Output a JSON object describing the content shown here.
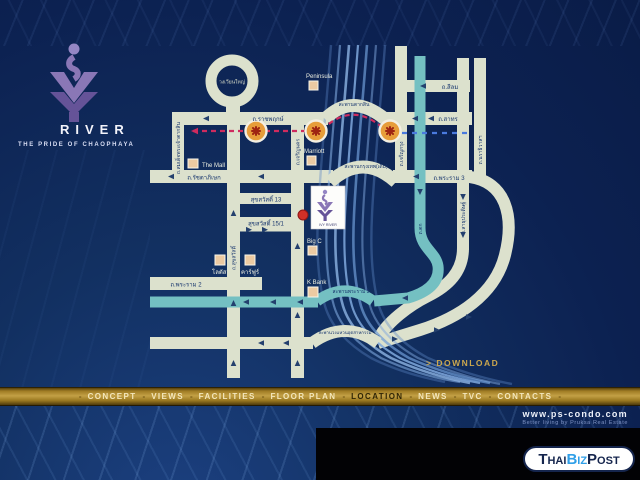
{
  "brand": {
    "name": "RIVER",
    "tagline": "THE PRIDE OF CHAOPHAYA"
  },
  "map": {
    "roundabout": "วงเวียนใหญ่",
    "road_labels": {
      "ratchaphruek": "ถ.ราชพฤกษ์",
      "taksin_bridge": "สะพานตากสิน",
      "sathorn": "ถ.สาทร",
      "silom": "ถ.สีลม",
      "ratchadaphisek": "ถ.รัชดาภิเษก",
      "krungthep_bridge": "สะพานกรุงเทพ(เดิม)",
      "rama3": "ถ.พระราม 3",
      "suksawat13": "สุขสวัสดิ์ 13",
      "suksawat15": "สุขสวัสดิ์ 15/1",
      "rama2": "ถ.พระราม 2",
      "rama3_bridge": "สะพานพระราม 3",
      "industrial_ring_bridge": "สะพานวงแหวนอุตสาหกรรม",
      "taksin_road": "ถ.สมเด็จพระเจ้าตากสิน",
      "suksawat": "ถ.สุขสวัสดิ์",
      "charoen_nakhon": "ถ.เจริญนคร",
      "charoen_krung": "ถ.เจริญกรุง",
      "tok": "ถ.ตก",
      "sathupradit": "ถ.สาธุประดิษฐ์",
      "narathiwat": "ถ.นราธิวาสฯ"
    },
    "landmarks": {
      "peninsula": "Peninsula",
      "marriott": "Marriott",
      "the_mall": "The Mall",
      "lotus": "โลตัส",
      "carrefour": "คาร์ฟูร์",
      "bigc": "Big C",
      "kbank": "K Bank"
    },
    "marker_label": "IVY RIVER",
    "download_label": "> DOWNLOAD"
  },
  "nav": {
    "separator": "-",
    "active": "LOCATION",
    "items": [
      "CONCEPT",
      "VIEWS",
      "FACILITIES",
      "FLOOR PLAN",
      "LOCATION",
      "NEWS",
      "TVC",
      "CONTACTS"
    ]
  },
  "footer": {
    "url": "www.ps-condo.com",
    "tagline": "Better living by Pruksa Real Estate"
  },
  "watermark": {
    "part1": "Thai",
    "part2": "Biz",
    "part3": "Post"
  },
  "colors": {
    "background_navy": "#0c2151",
    "road_beige": "#dce1cd",
    "route_teal": "#74c0c2",
    "river_blue": "#7fa8dd",
    "bts_red": "#cf2b5e",
    "bts_blue": "#4a7ade",
    "station_orange": "#e79d3a",
    "gold": "#c3a045",
    "brand_purple": "#7b68ae",
    "marker_red": "#d13028"
  }
}
